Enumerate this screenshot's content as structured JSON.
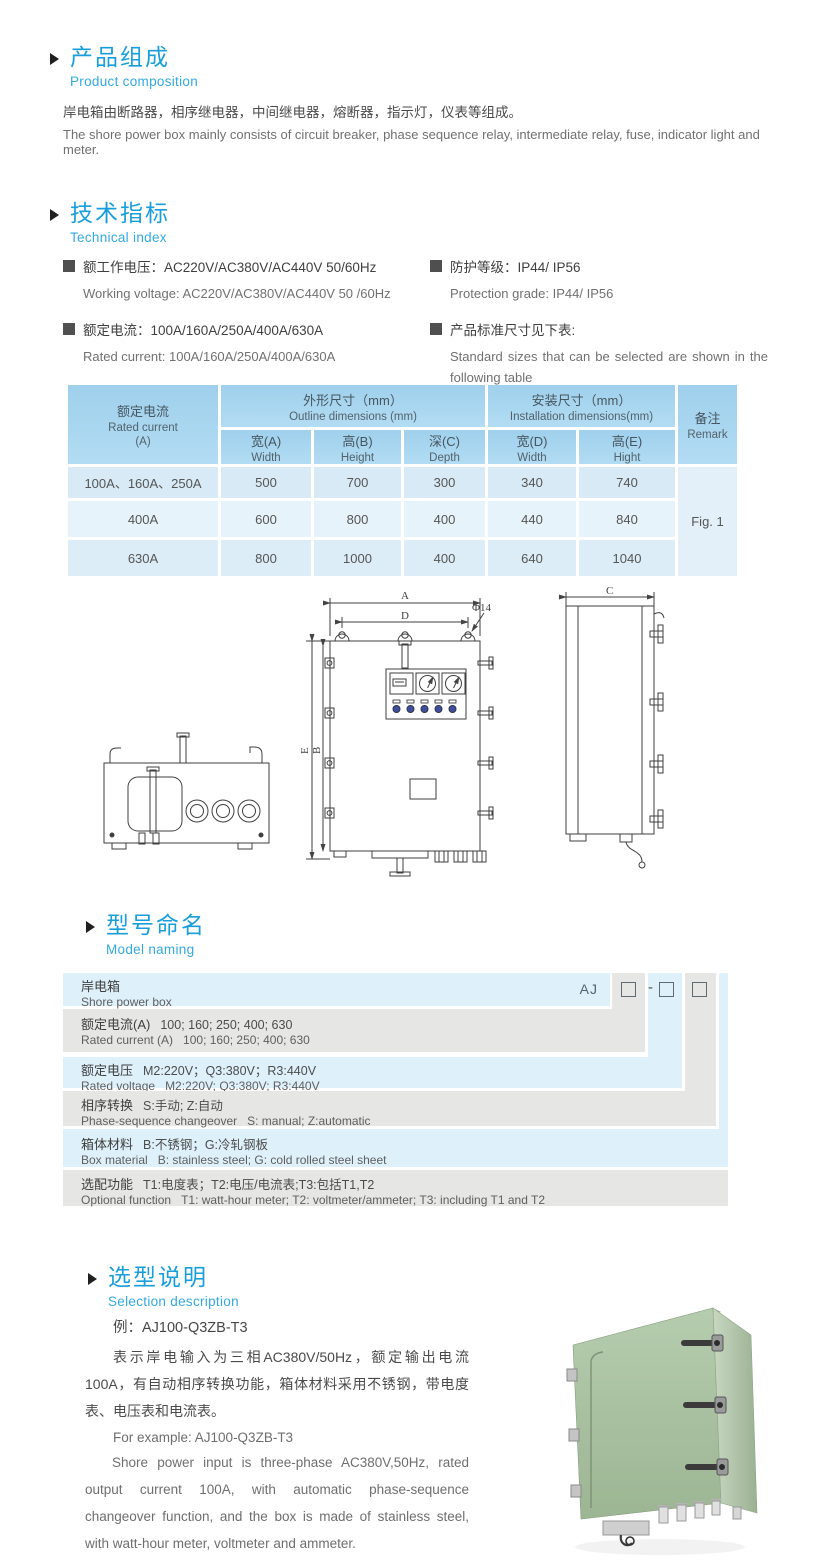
{
  "page": {
    "accent": "#189edb"
  },
  "composition": {
    "title_zh": "产品组成",
    "title_en": "Product  composition",
    "body_zh": "岸电箱由断路器，相序继电器，中间继电器，熔断器，指示灯，仪表等组成。",
    "body_en": "The shore power box mainly consists of circuit breaker, phase sequence relay, intermediate relay, fuse, indicator light and meter."
  },
  "technical": {
    "title_zh": "技术指标",
    "title_en": "Technical index",
    "left": [
      {
        "zh": "额工作电压：AC220V/AC380V/AC440V  50/60Hz",
        "en": "Working voltage: AC220V/AC380V/AC440V 50 /60Hz"
      },
      {
        "zh": "额定电流：100A/160A/250A/400A/630A",
        "en": "Rated current: 100A/160A/250A/400A/630A"
      }
    ],
    "right": [
      {
        "zh": "防护等级：IP44/ IP56",
        "en": "Protection grade: IP44/ IP56"
      },
      {
        "zh": "产品标准尺寸见下表:",
        "en": "Standard sizes that can be selected are shown in the following table"
      }
    ]
  },
  "size_table": {
    "current_zh": "额定电流",
    "current_en": "Rated current",
    "current_unit": "(A)",
    "outline_zh": "外形尺寸（mm）",
    "outline_en": "Outline dimensions (mm)",
    "install_zh": "安装尺寸（mm）",
    "install_en": "Installation dimensions(mm)",
    "remark_zh": "备注",
    "remark_en": "Remark",
    "sub": [
      {
        "zh": "宽(A)",
        "en": "Width"
      },
      {
        "zh": "高(B)",
        "en": "Height"
      },
      {
        "zh": "深(C)",
        "en": "Depth"
      },
      {
        "zh": "宽(D)",
        "en": "Width"
      },
      {
        "zh": "高(E)",
        "en": "Hight"
      }
    ],
    "rows": [
      {
        "current": "100A、160A、250A",
        "w": "500",
        "h": "700",
        "d": "300",
        "iw": "340",
        "ih": "740"
      },
      {
        "current": "400A",
        "w": "600",
        "h": "800",
        "d": "400",
        "iw": "440",
        "ih": "840"
      },
      {
        "current": "630A",
        "w": "800",
        "h": "1000",
        "d": "400",
        "iw": "640",
        "ih": "1040"
      }
    ],
    "remark_value": "Fig. 1"
  },
  "drawing": {
    "labels": {
      "A": "A",
      "B": "B",
      "C": "C",
      "D": "D",
      "E": "E",
      "phi": "Φ14"
    }
  },
  "naming": {
    "title_zh": "型号命名",
    "title_en": "Model naming",
    "prefix": "AJ",
    "dash": "-",
    "rows": [
      {
        "label_zh": "岸电箱",
        "value_zh": "",
        "label_en": "Shore power box",
        "value_en": ""
      },
      {
        "label_zh": "额定电流(A)",
        "value_zh": "100; 160; 250; 400; 630",
        "label_en": "Rated current (A)",
        "value_en": "100; 160; 250; 400; 630"
      },
      {
        "label_zh": "额定电压",
        "value_zh": "M2:220V；Q3:380V；R3:440V",
        "label_en": "Rated voltage",
        "value_en": "M2:220V;  Q3:380V;  R3:440V"
      },
      {
        "label_zh": "相序转换",
        "value_zh": "S:手动; Z:自动",
        "label_en": "Phase-sequence changeover",
        "value_en": "S: manual;  Z:automatic"
      },
      {
        "label_zh": "箱体材料",
        "value_zh": "B:不锈钢；G:冷轧钢板",
        "label_en": "Box material",
        "value_en": "B: stainless steel; G: cold rolled steel sheet"
      },
      {
        "label_zh": "选配功能",
        "value_zh": "T1:电度表；T2:电压/电流表;T3:包括T1,T2",
        "label_en": "Optional function",
        "value_en": "T1: watt-hour meter; T2: voltmeter/ammeter; T3: including T1 and T2"
      }
    ]
  },
  "selection": {
    "title_zh": "选型说明",
    "title_en": "Selection description",
    "example_zh": "例：AJ100-Q3ZB-T3",
    "body_zh": "表示岸电输入为三相AC380V/50Hz，额定输出电流100A，有自动相序转换功能，箱体材料采用不锈钢，带电度表、电压表和电流表。",
    "example_en": "For example: AJ100-Q3ZB-T3",
    "body_en": "Shore power input is three-phase AC380V,50Hz, rated output current 100A, with automatic phase-sequence changeover function, and the box is made of stainless steel, with watt-hour meter, voltmeter and ammeter."
  }
}
